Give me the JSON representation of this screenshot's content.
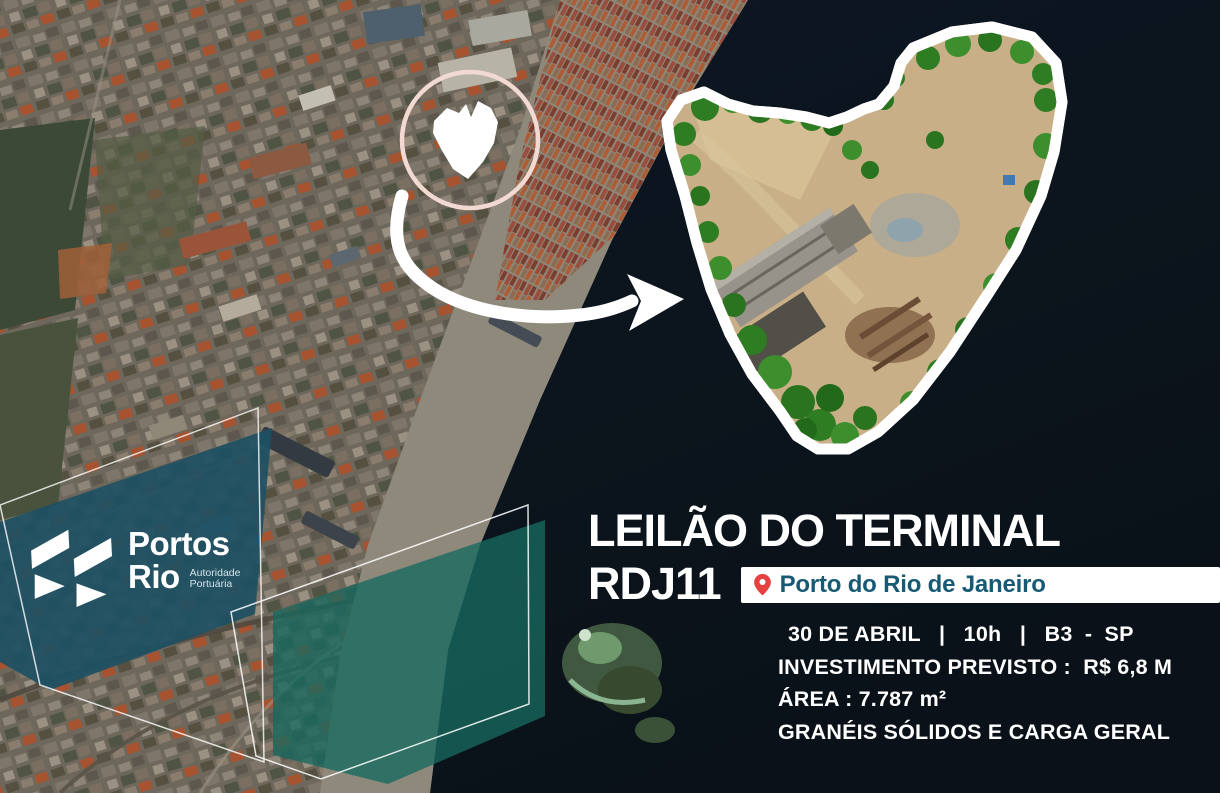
{
  "brand": {
    "name_line1": "Portos",
    "name_line2": "Rio",
    "subtitle_line1": "Autoridade",
    "subtitle_line2": "Portuária"
  },
  "headline": {
    "line1": "LEILÃO DO TERMINAL",
    "line2": "RDJ11"
  },
  "location": {
    "icon": "location-pin",
    "label": "Porto do Rio de Janeiro"
  },
  "details": {
    "date_line": "30 DE ABRIL   |   10h   |   B3  -  SP",
    "investment": "INVESTIMENTO PREVISTO :  R$ 6,8 M",
    "area": "ÁREA : 7.787 m²",
    "cargo": "GRANÉIS SÓLIDOS E CARGA GERAL"
  },
  "colors": {
    "accent_red": "#e5413e",
    "teal_text": "#175a74",
    "panel_teal": "#1d5064",
    "overlay_teal": "#17695f",
    "circle_pink": "#f2d9d1",
    "water_dark": "#0c131e"
  }
}
